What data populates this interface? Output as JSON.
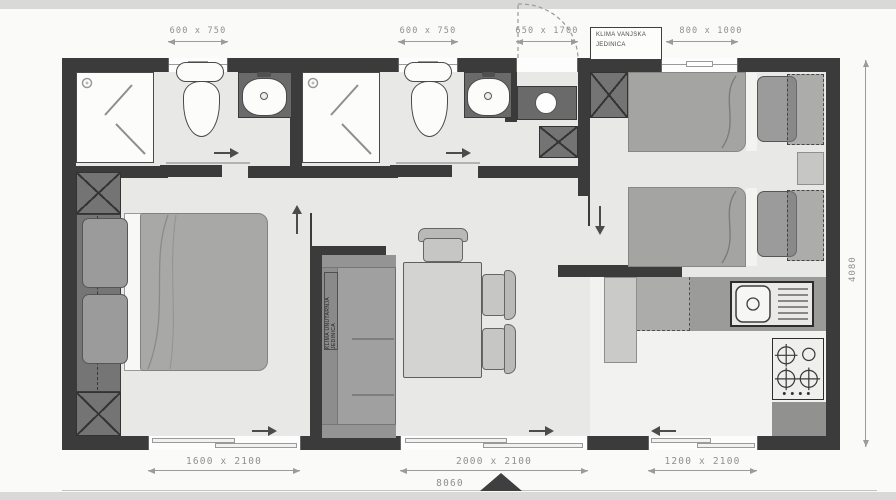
{
  "plan": {
    "title": "mobile-home-floor-plan",
    "overall": {
      "width": "8060",
      "depth": "4080"
    },
    "dimensions_top": [
      {
        "id": "bathroom-1-window",
        "label": "600 x 750"
      },
      {
        "id": "bathroom-2-window",
        "label": "600 x 750"
      },
      {
        "id": "entry-door",
        "label": "650 x 1700"
      },
      {
        "id": "bedroom-2-window",
        "label": "800 x 1000"
      }
    ],
    "dimensions_bottom": [
      {
        "id": "bedroom-1-sliding-window",
        "label": "1600 x 2100"
      },
      {
        "id": "living-room-sliding-door",
        "label": "2000 x 2100"
      },
      {
        "id": "kitchen-sliding-window",
        "label": "1200 x 2100"
      }
    ],
    "annotations": {
      "ac_outdoor": "KLIMA VANJSKA JEDINICA",
      "ac_indoor": "KLIMA UNUTARNJA JEDINICA"
    },
    "colors": {
      "wall": "#3b3b3c",
      "floor": "#e8e8e7",
      "dimension_text": "#8f8f8f",
      "furniture_gray": "#a0a0a0"
    }
  }
}
